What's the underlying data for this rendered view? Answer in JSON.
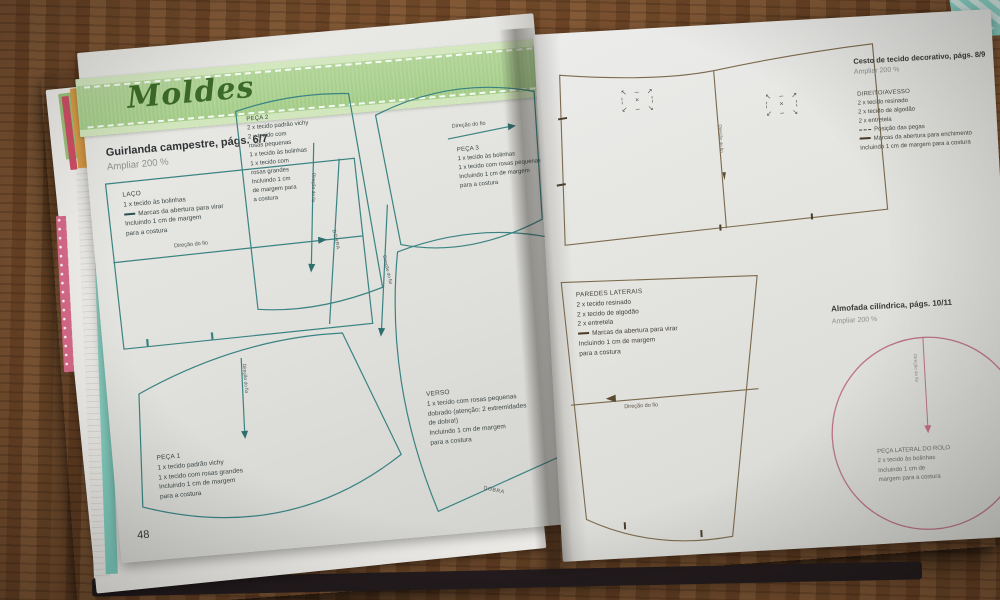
{
  "banner": {
    "title": "Moldes"
  },
  "page_number": "48",
  "labels": {
    "grain": "Direção do fio",
    "fold": "DOBRA"
  },
  "guirlanda": {
    "title": "Guirlanda campestre, págs. 6/7",
    "scale": "Ampliar 200 %",
    "laco": {
      "name": "LAÇO",
      "l1": "1 x tecido às bolinhas",
      "l2": "Marcas da abertura para virar",
      "l3": "Incluindo 1 cm de margem",
      "l4": "para a costura"
    },
    "peca2": {
      "name": "PEÇA 2",
      "lines": [
        "2 x tecido padrão vichy",
        "2 x tecido com",
        "rosas pequenas",
        "1 x tecido às bolinhas",
        "1 x tecido com",
        "rosas grandes",
        "Incluindo 1 cm",
        "de margem para",
        "a costura"
      ]
    },
    "peca3": {
      "name": "PEÇA 3",
      "lines": [
        "1 x tecido às bolinhas",
        "1 x tecido com rosas pequenas",
        "Incluindo 1 cm de margem",
        "para a costura"
      ]
    },
    "peca1": {
      "name": "PEÇA 1",
      "lines": [
        "1 x tecido padrão vichy",
        "1 x tecido com rosas grandes",
        "Incluindo 1 cm de margem",
        "para a costura"
      ]
    },
    "verso": {
      "name": "VERSO",
      "lines": [
        "1 x tecido com rosas pequenas",
        "dobrado (atenção: 2 extremidades",
        "de dobra!)",
        "Incluindo 1 cm de margem",
        "para a costura"
      ]
    }
  },
  "cesto": {
    "title": "Cesto de tecido decorativo, págs. 8/9",
    "scale": "Ampliar 200 %",
    "legend_title": "DIREITO/AVESSO",
    "l1": "2 x tecido resinado",
    "l2": "2 x tecido de algodão",
    "l3": "2 x entretela",
    "pegas": "Posição das pegas",
    "abertura": "Marcas da abertura para enchimento",
    "margem": "Incluindo 1 cm de margem para a costura"
  },
  "paredes": {
    "name": "PAREDES LATERAIS",
    "l1": "2 x tecido resinado",
    "l2": "2 x tecido de algodão",
    "l3": "2 x entretela",
    "abertura": "Marcas da abertura para virar",
    "m1": "Incluindo 1 cm de margem",
    "m2": "para a costura"
  },
  "almofada": {
    "title": "Almofada cilíndrica, págs. 10/11",
    "scale": "Ampliar 200 %",
    "c1": "PEÇA LATERAL DO ROLO",
    "c2": "2 x tecido às bolinhas",
    "c3": "Incluindo 1 cm de",
    "c4": "margem para a costura"
  },
  "colors": {
    "teal_line": "#3a8382",
    "brown_line": "#7b6a4d",
    "pink_line": "#bb7489",
    "ribbon_green": "#a9cf92",
    "wood": "#734b2b"
  }
}
